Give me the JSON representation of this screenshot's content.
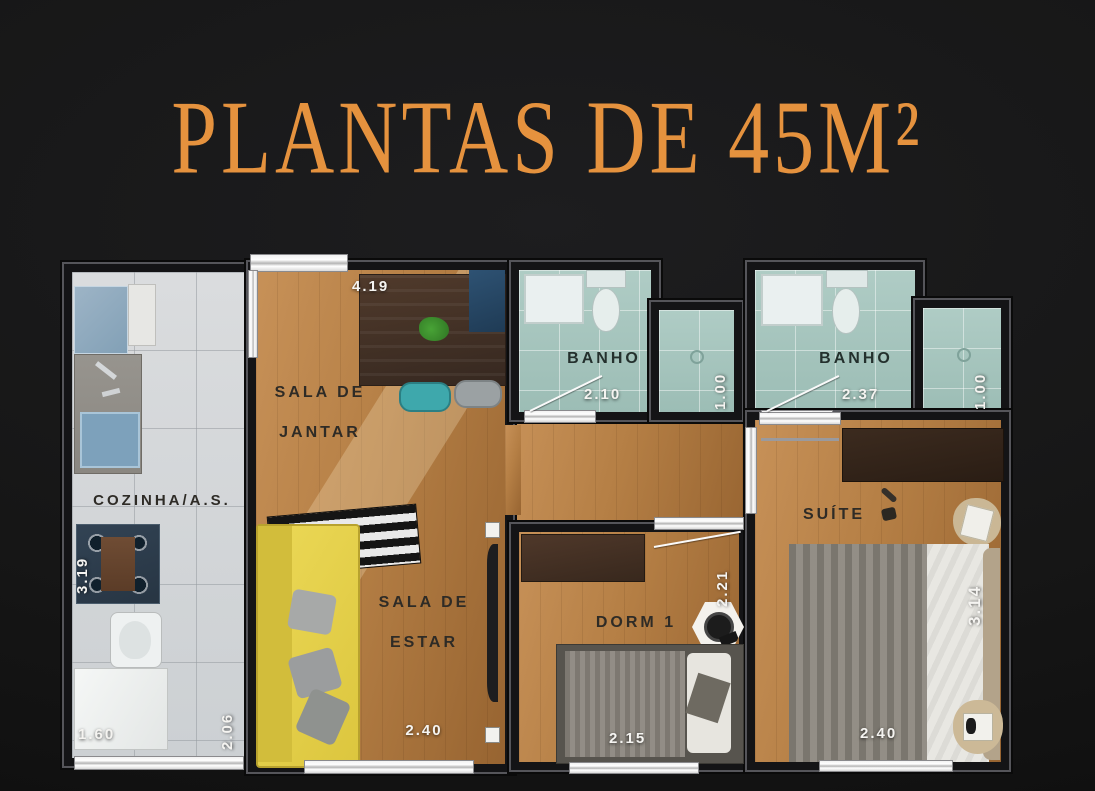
{
  "title": "PLANTAS DE 45M²",
  "colors": {
    "accent_orange": "#E5923E",
    "background": "#161616",
    "wood_floor": "#B57F45",
    "kitchen_tile": "#D7DADC",
    "bathroom_tile": "#A6C6BF",
    "sofa_yellow": "#E5D14C",
    "wall": "#141416",
    "dimension_text": "#F5F4F1",
    "room_label_text": "#2E2B26"
  },
  "plan": {
    "kitchen": {
      "label": "COZINHA/A.S.",
      "dim_left": "3.19",
      "dim_bottom": "1.60",
      "dim_right": "2.06"
    },
    "dining_room": {
      "label_line1": "SALA DE",
      "label_line2": "JANTAR",
      "dim_top": "4.19"
    },
    "living_room": {
      "label_line1": "SALA DE",
      "label_line2": "ESTAR",
      "dim_bottom": "2.40"
    },
    "bathroom_1": {
      "label": "BANHO",
      "dim_bottom": "2.10",
      "dim_shower": "1.00"
    },
    "bathroom_2": {
      "label": "BANHO",
      "dim_bottom": "2.37",
      "dim_shower": "1.00"
    },
    "bedroom_1": {
      "label": "DORM 1",
      "dim_right": "2.21",
      "dim_bottom": "2.15"
    },
    "suite": {
      "label": "SUÍTE",
      "dim_right": "3.14",
      "dim_bottom": "2.40"
    }
  }
}
